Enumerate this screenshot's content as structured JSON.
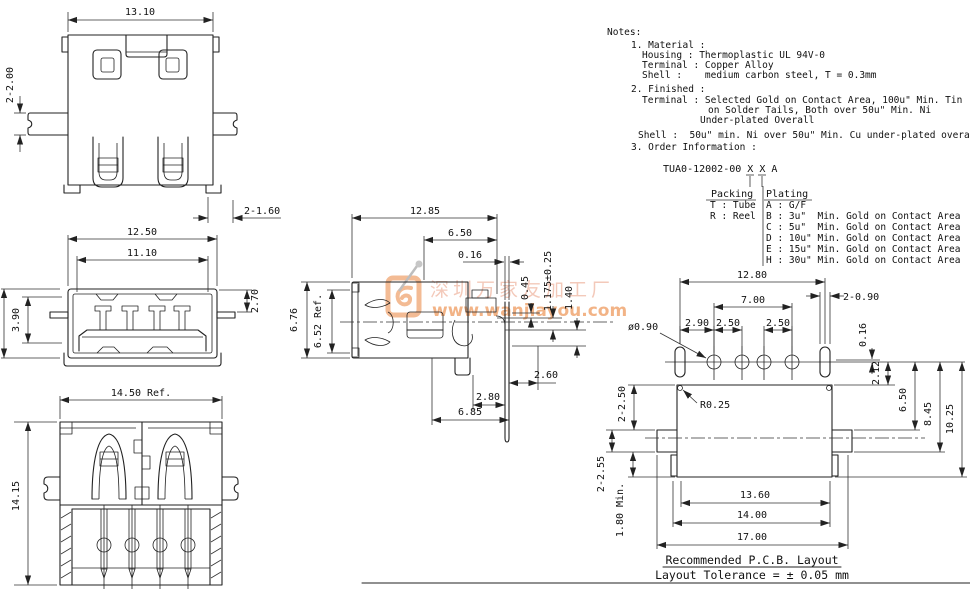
{
  "colors": {
    "line": "#222222",
    "watermark_text": "#f2c0ae",
    "watermark_url": "#f0a169",
    "watermark_logo": "#f0a571"
  },
  "watermark": {
    "cn": "深圳万家友加工厂",
    "url": "www.wanjiayou.com"
  },
  "notes": {
    "title": "Notes:",
    "n1": "1. Material :",
    "n1a": "Housing : Thermoplastic UL 94V-0",
    "n1b": "Terminal : Copper Alloy",
    "n1c": "Shell :    medium carbon steel, T = 0.3mm",
    "n2": "2. Finished :",
    "n2a": "Terminal : Selected Gold on Contact Area, 100u\" Min. Tin",
    "n2b": "on Solder Tails, Both over 50u\" Min. Ni",
    "n2c": "Under-plated Overall",
    "n2d": "Shell :  50u\" min. Ni over 50u\" Min. Cu under-plated overall",
    "n3": "3. Order Information :"
  },
  "order": {
    "part": "TUA0-12002-00 X X A",
    "packing_header": "Packing",
    "plating_header": "Plating",
    "packing": [
      "T : Tube",
      "R : Reel"
    ],
    "plating": [
      "A : G/F",
      "B : 3u\"  Min. Gold on Contact Area",
      "C : 5u\"  Min. Gold on Contact Area",
      "D : 10u\" Min. Gold on Contact Area",
      "E : 15u\" Min. Gold on Contact Area",
      "H : 30u\" Min. Gold on Contact Area"
    ]
  },
  "top_view": {
    "w": "13.10",
    "tab": "2-2.00",
    "foot": "2-1.60"
  },
  "front_view": {
    "w1": "12.50",
    "w2": "11.10",
    "h1": "3.90",
    "h2": "2.70"
  },
  "bottom_view": {
    "w": "14.50 Ref.",
    "h": "14.15"
  },
  "side_view": {
    "l1": "12.85",
    "l2": "6.50",
    "l3": "0.16",
    "v1": "0.45",
    "v2": "1.175±0.25",
    "v3": "1.40",
    "h1": "6.76",
    "h2": "6.52 Ref.",
    "b1": "2.60",
    "b2": "2.80",
    "b3": "6.85"
  },
  "pcb": {
    "w": "12.80",
    "pitch": "7.00",
    "slot": "2-0.90",
    "p1": "2.90",
    "p2": "2.50",
    "p3": "2.50",
    "hole": "ø0.90",
    "off1": "0.16",
    "off2": "2.12",
    "fillet": "R0.25",
    "v1": "6.50",
    "v2": "8.45",
    "v3": "10.25",
    "l1": "2-2.50",
    "l2": "2-2.55",
    "l3": "1.80 Min.",
    "b1": "13.60",
    "b2": "14.00",
    "b3": "17.00",
    "title": "Recommended P.C.B. Layout",
    "tolerance": "Layout Tolerance = ± 0.05 mm"
  }
}
